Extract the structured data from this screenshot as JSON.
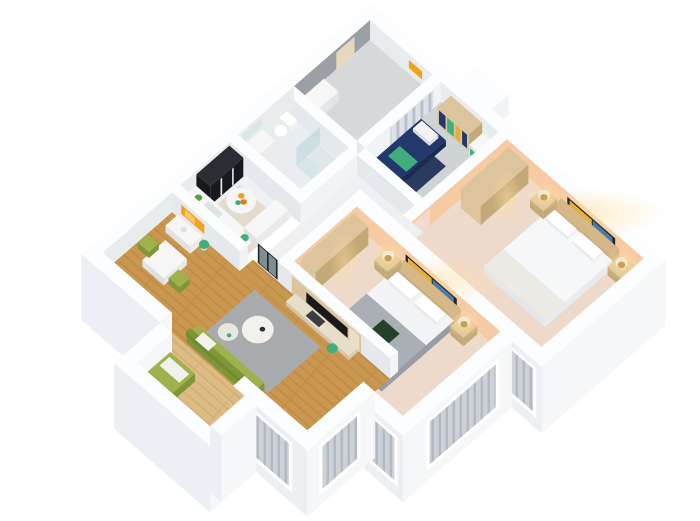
{
  "title": "3D isometric cutaway floor plan render of a two-bedroom apartment",
  "background": "#ffffff",
  "palette": {
    "wallTop": "#fcfdfe",
    "wallRight": "#f1f3f5",
    "wallLeft": "#e5e8ec",
    "extR": "#f5f7f9",
    "extL": "#eceff3",
    "innerGray": "#9aa0a5",
    "innerLight": "#e9eced",
    "peach": "#f6cba4",
    "floorStudy": "#ced3d6",
    "floorBath": "#e9edef",
    "floorTile": "#eef0f1",
    "floorGray": "#d6d8da",
    "floorRose": "#eedacb",
    "rug": "#a8abad",
    "navy": "#23386b",
    "navyDark": "#1a2a52",
    "green": "#9db14d",
    "greenDark": "#7e9638",
    "shelfGreen": "#3fae7c",
    "tan": "#dcc59c",
    "tanDark": "#c3a878",
    "counter": "#f5f6f5",
    "black": "#17191d",
    "darkGray": "#3a3d41",
    "artOrange": "#f0a21d",
    "artOrangeLight": "#f8c65a",
    "frame": "#20262e",
    "artYellow": "#e3ae3a",
    "artBlue": "#4a7aa8",
    "lampGlowColor": "#ffdf9f",
    "lampShade": "#f3e9d2",
    "lampBase": "#c9a050",
    "bedWhite": "#f6f7f8",
    "bedWhiteSide": "#e9ebee",
    "bedGray": "#a9afb5",
    "bedGraySide": "#969da4",
    "headboard": "#d6b888",
    "headboardDark": "#cbae7e",
    "glass": "#cfe3e6",
    "glassDark": "#b5d4d8",
    "blindBg": "#ccd1d7",
    "blindSlat": "#b2b9c1",
    "doorPink": "#f2dcd2",
    "doorTan": "#e6d9bf",
    "mirror": "#d8e6e9",
    "wood": "#c9974f",
    "woodDark": "#b5813c",
    "woodLight": "#dcbc84",
    "woodLightDark": "#c9a566",
    "laptop": "#25402b",
    "tray": "#dfe7e9",
    "marble": "#e2dbce"
  },
  "rooms": [
    {
      "id": "laundry-entry",
      "floor_key": "floorGray",
      "furniture": [
        "closet-door",
        "appliance",
        "small-orange-art"
      ]
    },
    {
      "id": "study",
      "floor_key": "floorStudy",
      "furniture": [
        "striped-curtain",
        "bookshelf",
        "green-cabinet",
        "navy-daybed",
        "navy-rug"
      ]
    },
    {
      "id": "bedroom-2",
      "floor_key": "floorRose",
      "furniture": [
        "wardrobe",
        "double-bed-white",
        "headboard",
        "nightstand-lamps",
        "framed-wall-art"
      ]
    },
    {
      "id": "bathroom",
      "floor_key": "floorBath",
      "furniture": [
        "shower-glass",
        "shower-tray",
        "vanity",
        "mirror",
        "toilet"
      ]
    },
    {
      "id": "hallway",
      "floor_key": "floorTile",
      "furniture": [
        "black-framed-glass-door",
        "pink-room-doors"
      ]
    },
    {
      "id": "master-bedroom",
      "floor_key": "floorRose",
      "furniture": [
        "wardrobe",
        "double-bed-gray",
        "headboard-cushions",
        "nightstand-lamps",
        "framed-wall-art",
        "foot-bench"
      ]
    },
    {
      "id": "kitchen",
      "floor_key": "floorTile",
      "furniture": [
        "tall-black-cabinets",
        "oven-hood",
        "white-counters",
        "round-island-table",
        "fruit-bowl"
      ]
    },
    {
      "id": "living-dining",
      "floor_key": "wood",
      "furniture": [
        "tv-panel-wall",
        "tv",
        "media-console",
        "gray-rug",
        "round-coffee-tables",
        "green-sofa",
        "dining-table",
        "green-chairs",
        "console-with-orange-art",
        "plants"
      ]
    },
    {
      "id": "balcony",
      "floor_key": "woodLight",
      "furniture": [
        "green-storage-bench"
      ]
    }
  ],
  "windows": {
    "style": "vertical-blinds",
    "frame": "#ffffff"
  }
}
